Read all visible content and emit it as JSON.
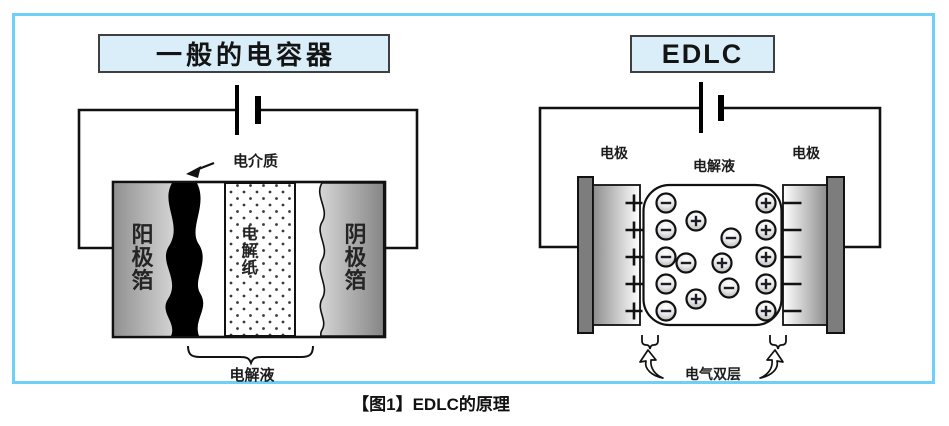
{
  "caption": "【图1】EDLC的原理",
  "left_diagram": {
    "title": "一般的电容器",
    "dielectric_label": "电介质",
    "anode_foil_label": "阳极箔",
    "electrolytic_paper_label": "电解纸",
    "cathode_foil_label": "阴极箔",
    "electrolyte_label": "电解液"
  },
  "right_diagram": {
    "title": "EDLC",
    "electrode_left_label": "电极",
    "electrolyte_label": "电解液",
    "electrode_right_label": "电极",
    "double_layer_label": "电气双层",
    "anion_column_count": 5,
    "cation_column_count": 5,
    "free_cation_count": 3,
    "free_anion_count": 3
  },
  "colors": {
    "frame_border": "#6ed0f6",
    "title_box_bg": "#d9eef8",
    "title_box_border": "#3f3f3f",
    "diagram_line": "#111111",
    "terminal_gray": "#7d7d7d"
  }
}
